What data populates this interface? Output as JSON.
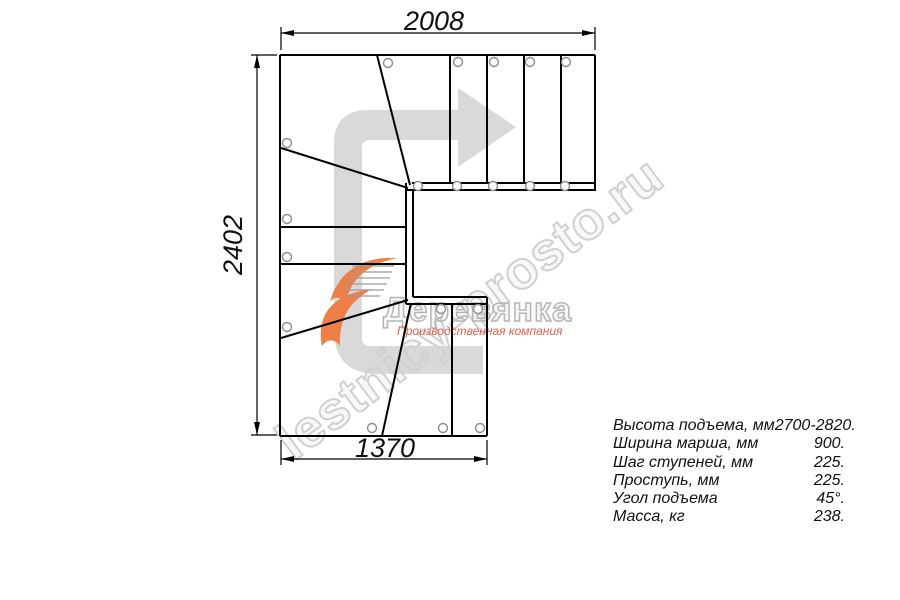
{
  "dimensions": {
    "top": "2008",
    "left": "2402",
    "bottom": "1370"
  },
  "specs": {
    "rows": [
      {
        "label": "Высота подъема, мм",
        "value": "2700-2820."
      },
      {
        "label": "Ширина марша, мм",
        "value": "900."
      },
      {
        "label": "Шаг ступеней, мм",
        "value": "225."
      },
      {
        "label": "Проступь, мм",
        "value": "225."
      },
      {
        "label": "Угол подъема",
        "value": "45°."
      },
      {
        "label": "Масса, кг",
        "value": "238."
      }
    ]
  },
  "watermark": {
    "site_text": "lestnicy-prosto.ru"
  },
  "logo": {
    "company_name": "Деревянка",
    "subtitle": "Производственная компания"
  },
  "colors": {
    "line": "#000000",
    "arrow_fill": "#d9d9d9",
    "watermark_gray": "#d0d0d0",
    "logo_orange": "#ee8046",
    "logo_red": "#e0604c",
    "screw_stroke": "#8c8c8c"
  }
}
